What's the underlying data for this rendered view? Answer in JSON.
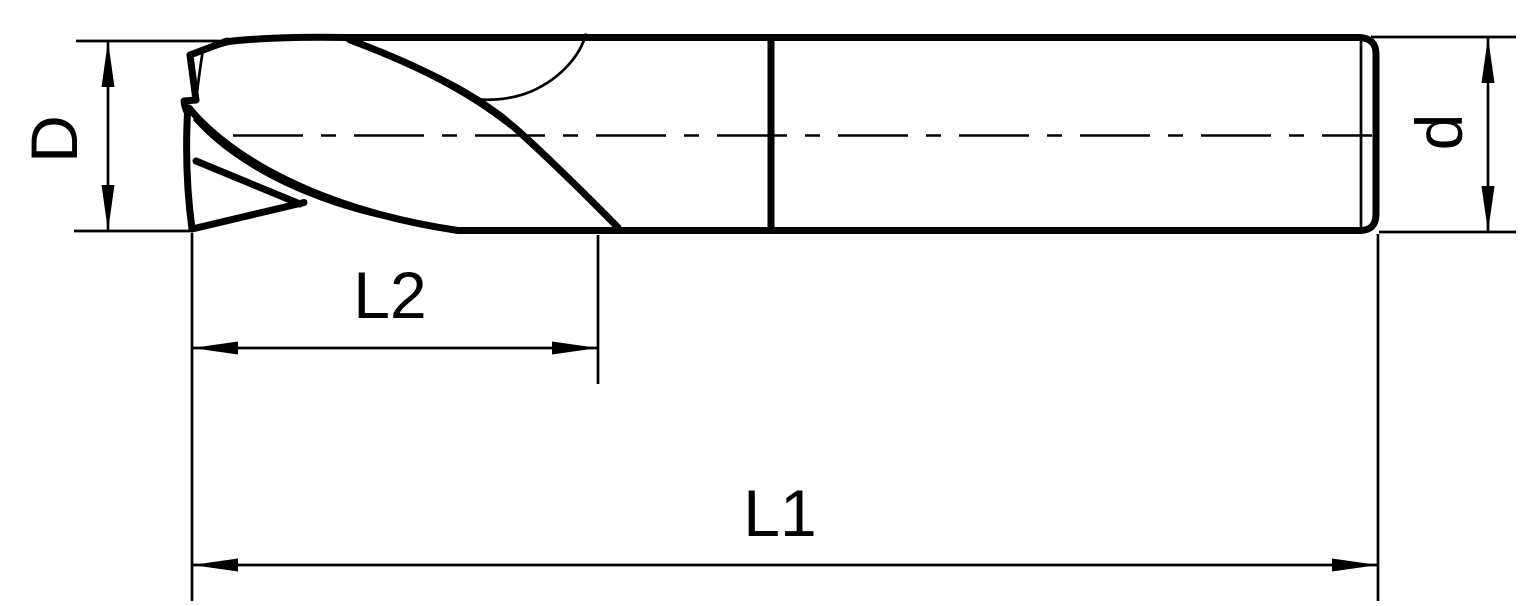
{
  "figure": {
    "kind": "engineering-dimension-drawing",
    "subject": "two-flute end mill, side view",
    "background_color": "#ffffff",
    "line_color": "#000000"
  },
  "labels": {
    "diameter": "D",
    "shank_diameter": "d",
    "flute_length": "L2",
    "overall_length": "L1"
  }
}
